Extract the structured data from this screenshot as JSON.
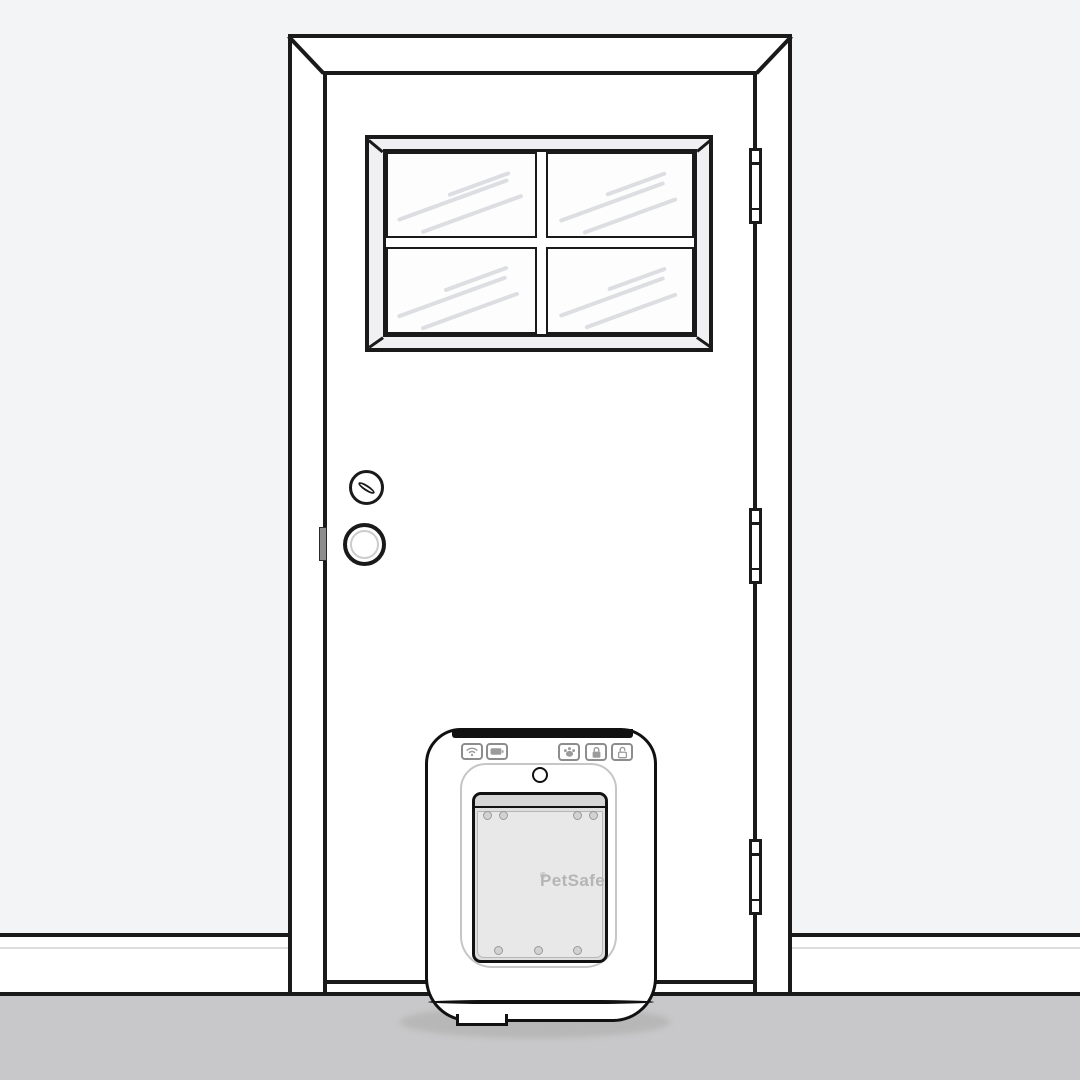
{
  "scene": {
    "description": "Line illustration of a closed exterior door with a four-pane window and a PetSafe electronic pet door installed at its base",
    "colors": {
      "wall": "#f3f4f6",
      "floor": "#c8c8ca",
      "outline": "#1a1a1a",
      "glass_streak": "#dcdee1",
      "flap": "#e8e8e8",
      "flap_hinge_bar": "#d6d6d6",
      "floor_shadow": "#b7b7b7",
      "brand_text": "#b5b5b5",
      "button_border": "#8d8d8d"
    }
  },
  "door": {
    "window": {
      "pane_rows": 2,
      "pane_cols": 2,
      "pane_count": 4
    },
    "hinge_count": 3,
    "hardware": [
      "deadbolt-thumb-turn",
      "round-knob",
      "strike-plate"
    ]
  },
  "pet_door": {
    "brand": "PetSafe",
    "registered_mark": "®",
    "indicator_buttons": [
      {
        "name": "wifi",
        "icon": "wifi-icon"
      },
      {
        "name": "battery",
        "icon": "battery-icon"
      }
    ],
    "control_buttons": [
      {
        "name": "paw",
        "icon": "paw-icon"
      },
      {
        "name": "lock",
        "icon": "lock-closed-icon"
      },
      {
        "name": "unlock",
        "icon": "lock-open-icon"
      }
    ],
    "screw_count_top": 4,
    "screw_count_bottom": 3
  }
}
